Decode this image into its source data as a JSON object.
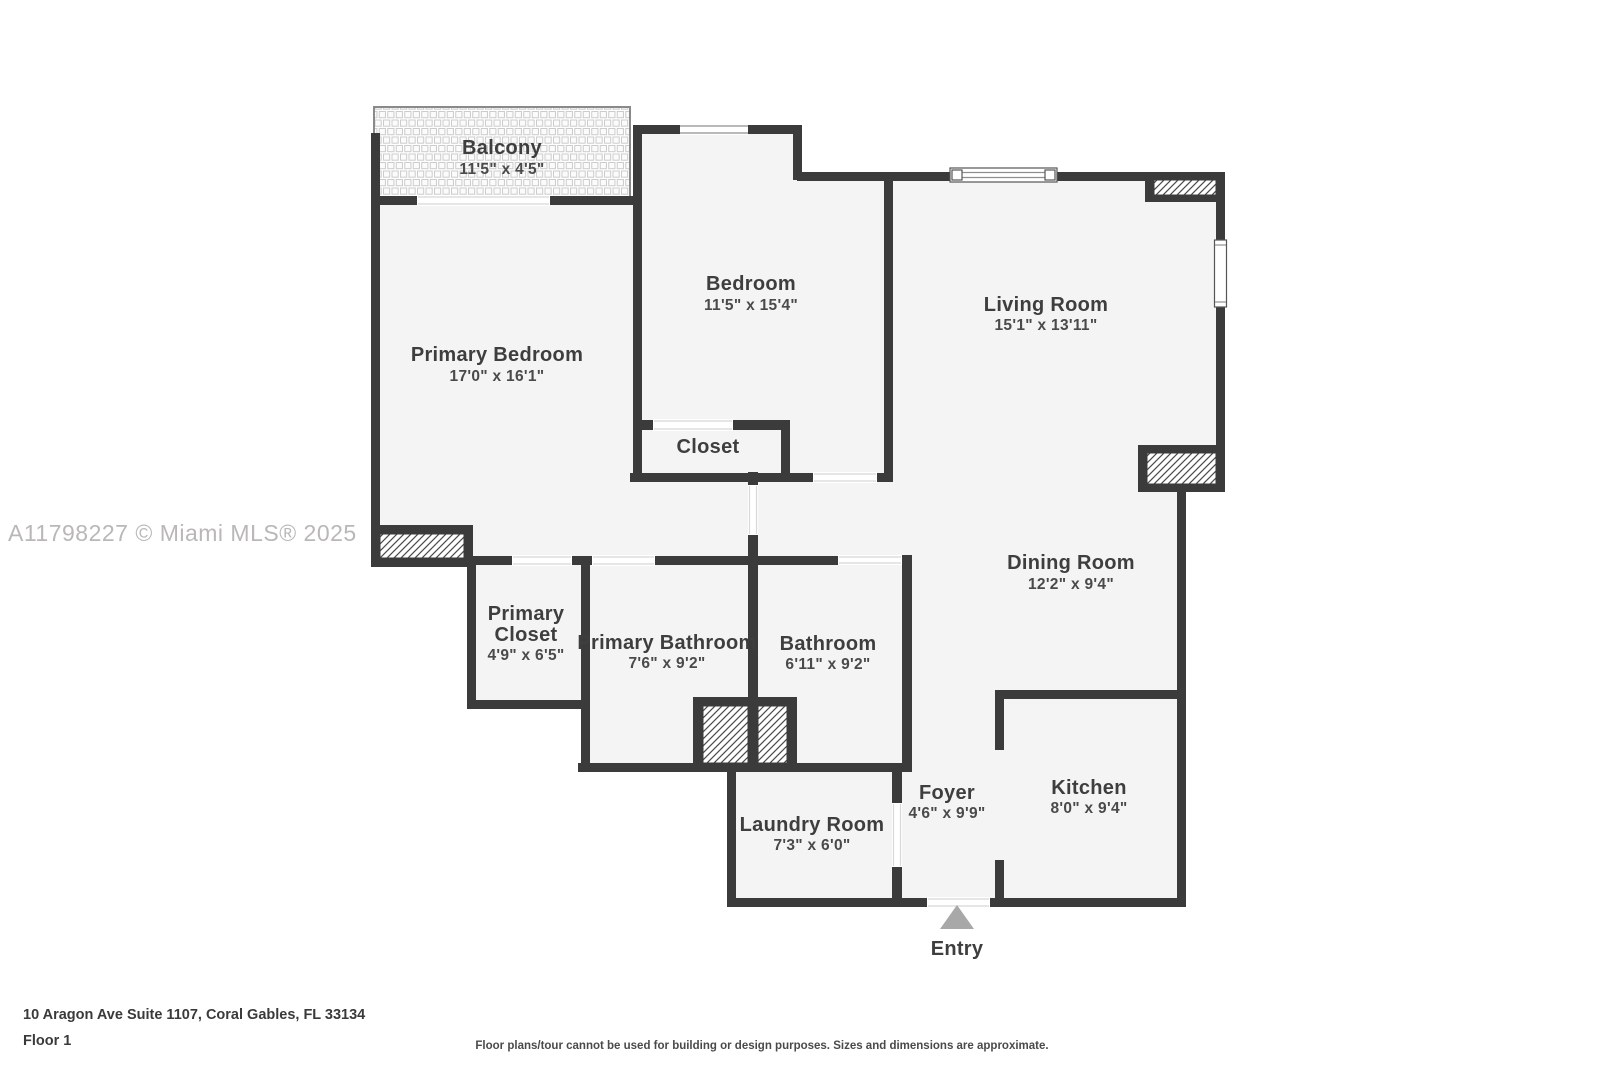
{
  "watermark": "A11798227 © Miami MLS® 2025",
  "rooms": {
    "balcony": {
      "name": "Balcony",
      "dims": "11'5\" x 4'5\""
    },
    "primary_bedroom": {
      "name": "Primary Bedroom",
      "dims": "17'0\" x 16'1\""
    },
    "bedroom": {
      "name": "Bedroom",
      "dims": "11'5\" x 15'4\""
    },
    "living_room": {
      "name": "Living Room",
      "dims": "15'1\" x 13'11\""
    },
    "closet": {
      "name": "Closet"
    },
    "primary_closet": {
      "name": "Primary Closet",
      "name_line1": "Primary",
      "name_line2": "Closet",
      "dims": "4'9\" x 6'5\""
    },
    "primary_bathroom": {
      "name": "Primary Bathroom",
      "dims": "7'6\" x 9'2\""
    },
    "bathroom": {
      "name": "Bathroom",
      "dims": "6'11\" x 9'2\""
    },
    "dining_room": {
      "name": "Dining Room",
      "dims": "12'2\" x 9'4\""
    },
    "laundry_room": {
      "name": "Laundry Room",
      "dims": "7'3\" x 6'0\""
    },
    "foyer": {
      "name": "Foyer",
      "dims": "4'6\" x 9'9\""
    },
    "kitchen": {
      "name": "Kitchen",
      "dims": "8'0\" x 9'4\""
    }
  },
  "entry": {
    "label": "Entry"
  },
  "footer": {
    "address": "10 Aragon Ave Suite 1107, Coral Gables, FL 33134",
    "floor": "Floor 1",
    "disclaimer": "Floor plans/tour cannot be used for building or design purposes. Sizes and dimensions are approximate."
  },
  "colors": {
    "wall": "#3b3b3b",
    "floor": "#f4f4f4",
    "hatch_line": "#4a4a4a",
    "entry_marker": "#a8a8a8",
    "label_text": "#3e3e3e",
    "watermark_text": "#b9b7b7"
  }
}
